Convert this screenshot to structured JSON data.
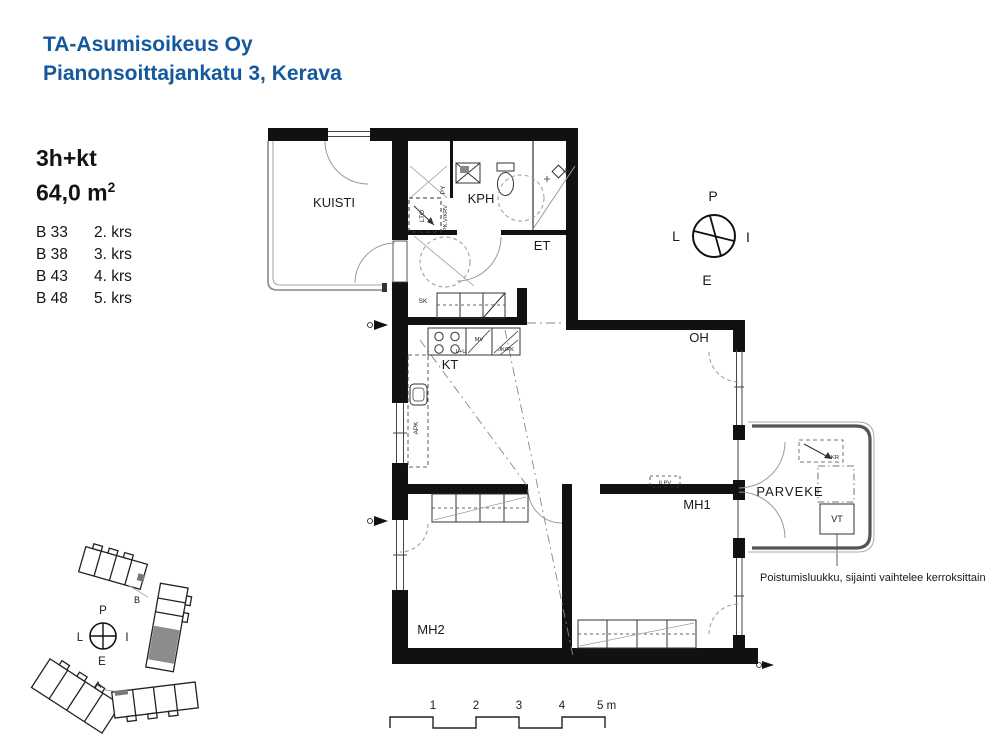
{
  "header": {
    "company": "TA-Asumisoikeus Oy",
    "address": "Pianonsoittajankatu 3, Kerava"
  },
  "apartment": {
    "type": "3h+kt",
    "area": "64,0 m",
    "area_exponent": "2",
    "units": [
      {
        "id": "B 33",
        "floor": "2. krs"
      },
      {
        "id": "B 38",
        "floor": "3. krs"
      },
      {
        "id": "B 43",
        "floor": "4. krs"
      },
      {
        "id": "B 48",
        "floor": "5. krs"
      }
    ]
  },
  "rooms": {
    "kuisti": "KUISTI",
    "kph": "KPH",
    "et": "ET",
    "kt": "KT",
    "oh": "OH",
    "mh1": "MH1",
    "mh2": "MH2",
    "parveke": "PARVEKE"
  },
  "fixtures": {
    "lto": "LTO",
    "py": "PY",
    "ppkv_krv": "PPK.V/KRV",
    "sk": "SK",
    "mv": "MV",
    "l_u": "L+U",
    "jk_pk": "JK/PK",
    "apk": "APK",
    "ilpv": "ILPV",
    "vt": "VT",
    "kr": "KR"
  },
  "compass": {
    "north": "P",
    "east": "I",
    "south": "E",
    "west": "L"
  },
  "site_plan": {
    "building_a": "A",
    "building_b": "B"
  },
  "scale_bar": {
    "ticks": [
      "1",
      "2",
      "3",
      "4"
    ],
    "end": "5 m"
  },
  "annotation": "Poistumisluukku, sijainti vaihtelee kerroksittain",
  "colors": {
    "brand_blue": "#14599c",
    "wall_black": "#111111",
    "highlight_gray": "#8c8c8c"
  }
}
